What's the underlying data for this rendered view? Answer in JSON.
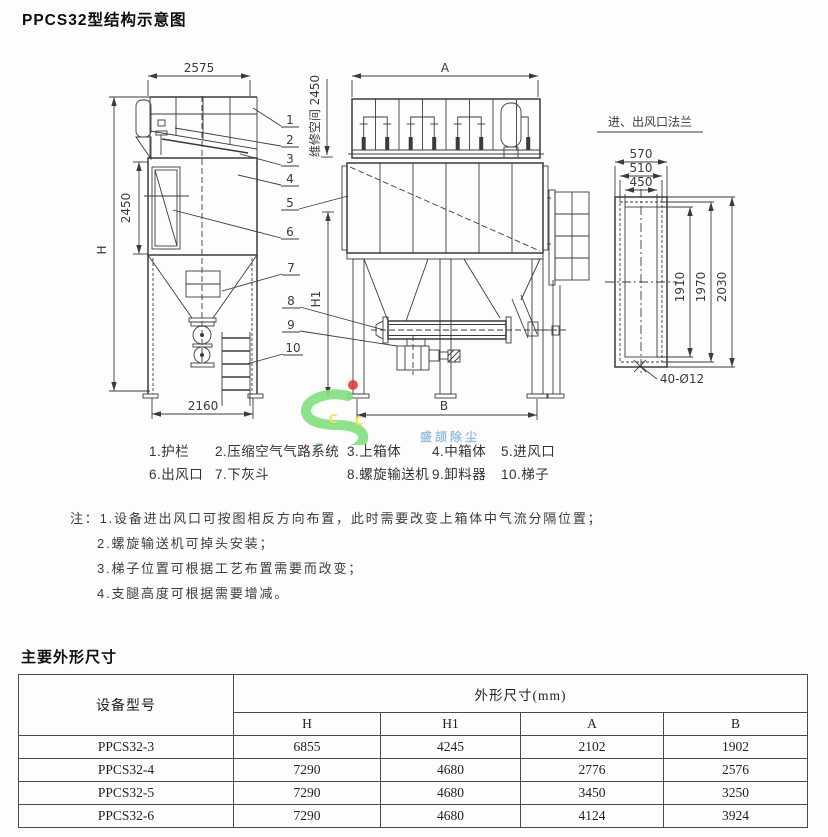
{
  "page": {
    "title": "PPCS32型结构示意图"
  },
  "drawing": {
    "side": {
      "width_top": "2575",
      "height_mid": "2450",
      "height_total": "H",
      "width_base": "2160"
    },
    "front": {
      "width_top": "A",
      "maintenance": "维修空间 2450",
      "height_h1": "H1",
      "width_base": "B"
    },
    "flange": {
      "title": "进、出风口法兰",
      "w_outer": "570",
      "w_bolt": "510",
      "w_inner": "450",
      "h_inner": "1910",
      "h_bolt": "1970",
      "h_outer": "2030",
      "holes": "40-Ø12"
    },
    "callouts": [
      "1",
      "2",
      "3",
      "4",
      "5",
      "6",
      "7",
      "8",
      "9",
      "10"
    ]
  },
  "watermark": {
    "c1": "C",
    "c2": "C",
    "brand": "盛颉除尘"
  },
  "colors": {
    "line": "#3b3b3b",
    "watermark_green": "#7ee07a",
    "watermark_blue": "#8cbade",
    "watermark_red": "#e23a35",
    "watermark_yellow": "#f2e14c"
  },
  "legend": {
    "row1": [
      "1.护栏",
      "2.压缩空气气路系统",
      "3.上箱体",
      "4.中箱体",
      "5.进风口"
    ],
    "row2": [
      "6.出风口",
      "7.下灰斗",
      "8.螺旋输送机",
      "9.卸料器",
      "10.梯子"
    ]
  },
  "notes": {
    "prefix": "注：",
    "lines": [
      "1.设备进出风口可按图相反方向布置，此时需要改变上箱体中气流分隔位置；",
      "2.螺旋输送机可掉头安装；",
      "3.梯子位置可根据工艺布置需要而改变；",
      "4.支腿高度可根据需要增减。"
    ]
  },
  "table": {
    "title": "主要外形尺寸",
    "col_model": "设备型号",
    "col_group": "外形尺寸(mm)",
    "sub_cols": [
      "H",
      "H1",
      "A",
      "B"
    ],
    "rows": [
      {
        "model": "PPCS32-3",
        "values": [
          "6855",
          "4245",
          "2102",
          "1902"
        ]
      },
      {
        "model": "PPCS32-4",
        "values": [
          "7290",
          "4680",
          "2776",
          "2576"
        ]
      },
      {
        "model": "PPCS32-5",
        "values": [
          "7290",
          "4680",
          "3450",
          "3250"
        ]
      },
      {
        "model": "PPCS32-6",
        "values": [
          "7290",
          "4680",
          "4124",
          "3924"
        ]
      }
    ]
  }
}
